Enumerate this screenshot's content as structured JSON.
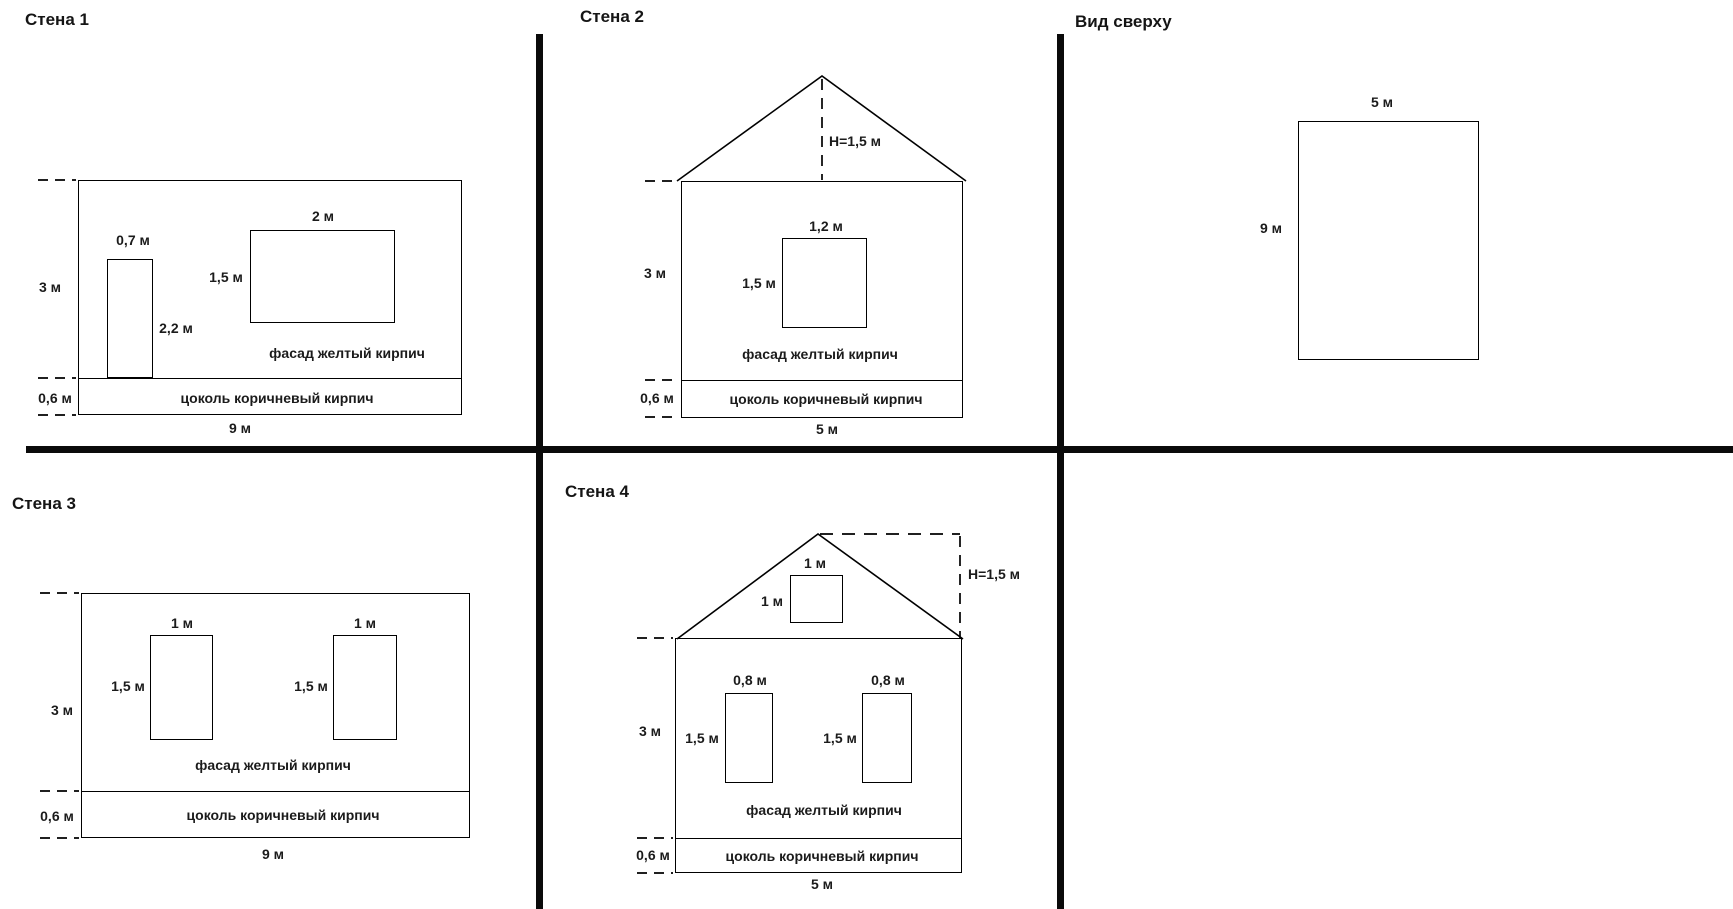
{
  "colors": {
    "line": "#000000",
    "text": "#1b1b1b",
    "background": "#ffffff"
  },
  "panels": {
    "wall1": {
      "title": "Стена 1",
      "wall_height": "3 м",
      "wall_width": "9 м",
      "door_width": "0,7 м",
      "door_height": "2,2 м",
      "window_width": "2 м",
      "window_height": "1,5 м",
      "plinth_height": "0,6 м",
      "facade": "фасад желтый кирпич",
      "plinth": "цоколь коричневый кирпич"
    },
    "wall2": {
      "title": "Стена 2",
      "roof_height": "H=1,5 м",
      "wall_height": "3 м",
      "wall_width": "5 м",
      "window_width": "1,2 м",
      "window_height": "1,5 м",
      "plinth_height": "0,6 м",
      "facade": "фасад желтый кирпич",
      "plinth": "цоколь коричневый кирпич"
    },
    "top_view": {
      "title": "Вид сверху",
      "width": "5 м",
      "depth": "9 м"
    },
    "wall3": {
      "title": "Стена 3",
      "wall_height": "3 м",
      "wall_width": "9 м",
      "window1_width": "1 м",
      "window1_height": "1,5 м",
      "window2_width": "1 м",
      "window2_height": "1,5 м",
      "plinth_height": "0,6 м",
      "facade": "фасад желтый кирпич",
      "plinth": "цоколь коричневый кирпич"
    },
    "wall4": {
      "title": "Стена 4",
      "roof_height": "H=1,5 м",
      "gable_window_width": "1 м",
      "gable_window_height": "1 м",
      "wall_height": "3 м",
      "wall_width": "5 м",
      "window1_width": "0,8 м",
      "window1_height": "1,5 м",
      "window2_width": "0,8 м",
      "window2_height": "1,5 м",
      "plinth_height": "0,6 м",
      "facade": "фасад желтый кирпич",
      "plinth": "цоколь коричневый кирпич"
    }
  }
}
